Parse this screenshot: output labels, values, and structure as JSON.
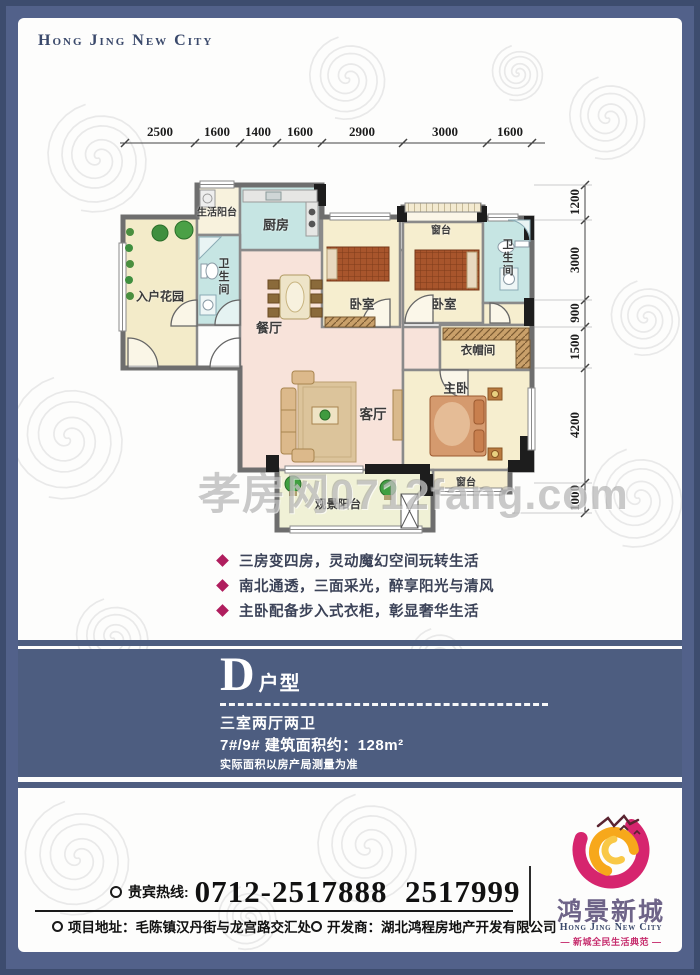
{
  "header": {
    "brand_en": "Hong Jing New City"
  },
  "plan": {
    "dims_top": [
      "2500",
      "1600",
      "1400",
      "1600",
      "2900",
      "3000",
      "1600"
    ],
    "dims_right": [
      "1200",
      "3000",
      "900",
      "1500",
      "4200",
      "1000"
    ],
    "rooms": {
      "entry_garden": "入户花园",
      "service_balcony": "生活阳台",
      "kitchen": "厨房",
      "bath1": "卫生间",
      "dining": "餐厅",
      "bedroom1": "卧室",
      "bay1": "窗台",
      "bedroom2": "卧室",
      "bath2": "卫生间",
      "cloakroom": "衣帽间",
      "living": "客厅",
      "master": "主卧",
      "bay2": "窗台",
      "view_balcony": "观景阳台"
    },
    "watermark": "孝房网0712fang.com"
  },
  "features": {
    "items": [
      "三房变四房，灵动魔幻空间玩转生活",
      "南北通透，三面采光，醉享阳光与清风",
      "主卧配备步入式衣柜，彰显奢华生活"
    ]
  },
  "unit_band": {
    "letter": "D",
    "suffix": "户型",
    "layout": "三室两厅两卫",
    "area_line": "7#/9# 建筑面积约：128m²",
    "disclaimer": "实际面积以房产局测量为准"
  },
  "footer": {
    "hotline_label": "贵宾热线:",
    "hotline_numbers": "0712-2517888  2517999",
    "address_label": "项目地址：",
    "address": "毛陈镇汉丹街与龙宫路交汇处",
    "developer_label": "开发商：",
    "developer": "湖北鸿程房地产开发有限公司"
  },
  "logo": {
    "brand_cn": "鸿景新城",
    "brand_en": "Hong Jing New City",
    "tagline": "— 新城全民生活典范 —"
  },
  "colors": {
    "band_navy": "#4d5d80",
    "border_navy": "#3d4c6e",
    "diamond_pink": "#b01e5e",
    "logo_pink": "#d6256e",
    "logo_orange": "#f7a81b",
    "brand_purple": "#6e6488",
    "room_cream": "#f6eecf",
    "room_teal": "#c6e5e3",
    "room_pink": "#f8e3da",
    "balcony_green": "#f0f1d6"
  }
}
